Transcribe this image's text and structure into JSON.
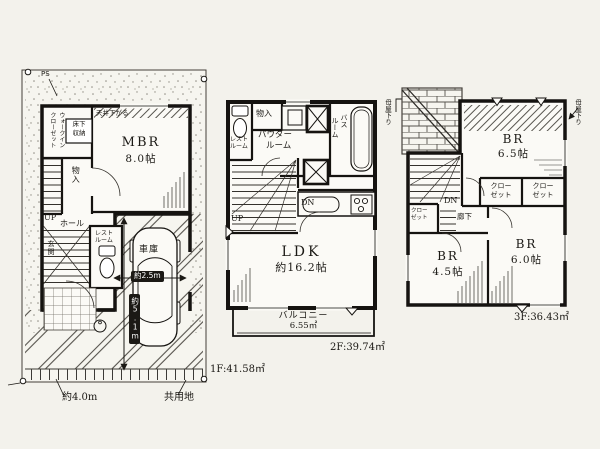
{
  "meta": {
    "bg_color": "#f3f2ec",
    "ink_color": "#1b1915",
    "paper_color": "#fbfaf6"
  },
  "floor1": {
    "ps": "PS",
    "walk_in_closet": {
      "l1": "ウォークイン",
      "l2": "クローゼット"
    },
    "floor_storage": {
      "l1": "床下",
      "l2": "収納"
    },
    "ceiling_note": "天井下がる",
    "mbr": {
      "name": "MBR",
      "size": "8.0帖"
    },
    "storage": "物入",
    "up": "UP",
    "hall": "ホール",
    "restroom": {
      "l1": "レスト",
      "l2": "ルーム"
    },
    "entrance": "玄関",
    "garage": {
      "name": "車庫",
      "width": "約2.5m",
      "depth": "約5.1m"
    },
    "area": "1F:41.58㎡",
    "front_width": "約4.0m",
    "shared_land": "共用地"
  },
  "floor2": {
    "restroom": {
      "l1": "レスト",
      "l2": "ルーム"
    },
    "storage": "物入",
    "powder_room": {
      "l1": "パウダー",
      "l2": "ルーム"
    },
    "bath": {
      "l1": "バス",
      "l2": "ルーム"
    },
    "up": "UP",
    "dn": "DN",
    "ldk": {
      "name": "LDK",
      "size": "約16.2帖"
    },
    "balcony": {
      "name": "バルコニー",
      "size": "6.55㎡"
    },
    "area": "2F:39.74㎡"
  },
  "floor3": {
    "roof_note_left": "母屋下り",
    "roof_note_right": "母屋下り",
    "br65": {
      "name": "BR",
      "size": "6.5帖"
    },
    "closets": [
      {
        "l1": "クロー",
        "l2": "ゼット"
      },
      {
        "l1": "クロー",
        "l2": "ゼット"
      },
      {
        "l1": "クロー",
        "l2": "ゼット"
      }
    ],
    "dn": "DN",
    "hallway": "廊下",
    "br45": {
      "name": "BR",
      "size": "4.5帖"
    },
    "br60": {
      "name": "BR",
      "size": "6.0帖"
    },
    "area": "3F:36.43㎡"
  }
}
